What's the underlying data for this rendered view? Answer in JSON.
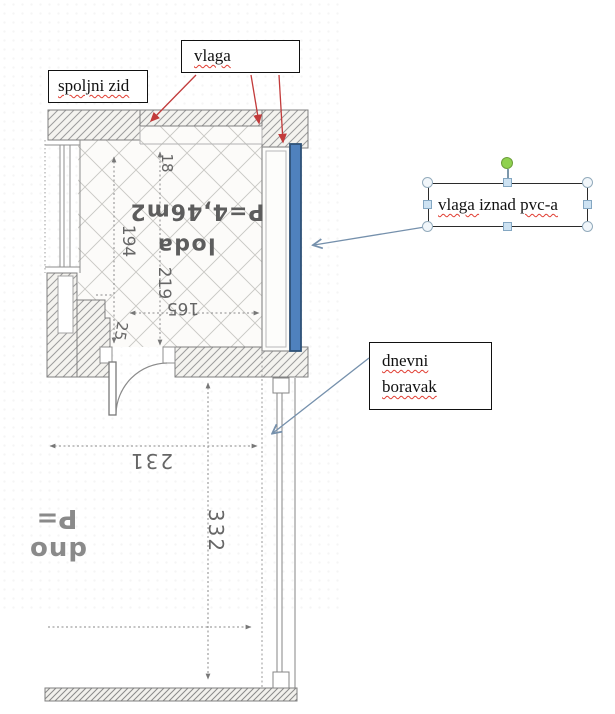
{
  "callout_boxes": {
    "spoljni_zid": {
      "label": "spoljni zid"
    },
    "vlaga": {
      "label": "vlaga"
    },
    "dnevni_boravak": {
      "line1": "dnevni",
      "line2": "boravak"
    },
    "selected": {
      "word1": "vlaga ",
      "word2": "iznad ",
      "word3": "pvc-a"
    }
  },
  "floorplan": {
    "room_name": "loda",
    "room_area": "P=4,46m2",
    "dim_18": "18",
    "dim_194": "194",
    "dim_219": "219",
    "dim_165": "165",
    "dim_25": "25",
    "dim_231": "231",
    "dim_332": "332",
    "partial_label_top": "P=",
    "partial_label_bottom": "dno"
  },
  "colors": {
    "moisture_bar_fill": "#4f81bd",
    "moisture_bar_stroke": "#2f5277",
    "red_arrow": "#c23b3b",
    "blue_arrow": "#7590ac",
    "rotation_handle": "#8fd14f",
    "spellcheck_underline": "#e03c31"
  }
}
